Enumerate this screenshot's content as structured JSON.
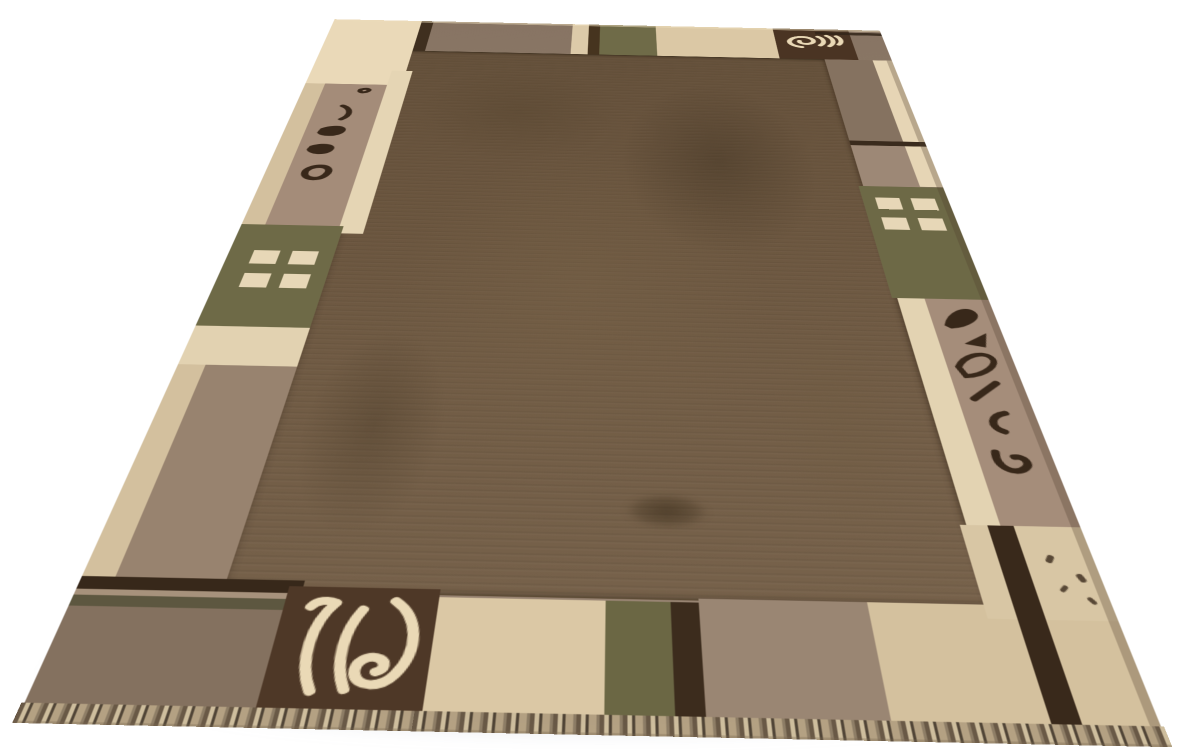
{
  "scene": {
    "type": "product-photo",
    "subject": "Hand-knotted wool area rug photographed in perspective on a seamless white background",
    "background_color": "#ffffff"
  },
  "rug": {
    "description": "Nepali-style wool rug: large chocolate-brown field framed by a patchwork border of cream, beige, taupe, mauve and olive-green blocks with dark accent stripes, two four-pane window motifs, spiral-leaf corner medallions, calligraphic leaf motifs on the side borders and a short knotted fringe along the lower edge",
    "palette": {
      "page-bg": "#ffffff",
      "field": "#6b563f",
      "base-taupe": "#8d7a69",
      "taupe-dark": "#84715f",
      "taupe-mid": "#9a8673",
      "mauve": "#a48c79",
      "mauve-light": "#a58d7a",
      "cream": "#e5d5b4",
      "cream-bright": "#ead9b8",
      "beige": "#dbc8a5",
      "beige-deep": "#d4c19e",
      "olive": "#6f6b48",
      "olive-stripe": "#5d5740",
      "dark-brown": "#3c2c1d",
      "motif-square": "#4a3423",
      "motif-cream": "#ead9b6",
      "motif-dark": "#38281a",
      "outer-beige": "#d3c09e"
    },
    "motifs": [
      "spiral-and-waves-top",
      "double-curve-and-leaf-spiral-bottom",
      "leaf-calligraphy-column-left",
      "leaf-calligraphy-column-right",
      "four-pane-window-left",
      "four-pane-window-right"
    ]
  }
}
